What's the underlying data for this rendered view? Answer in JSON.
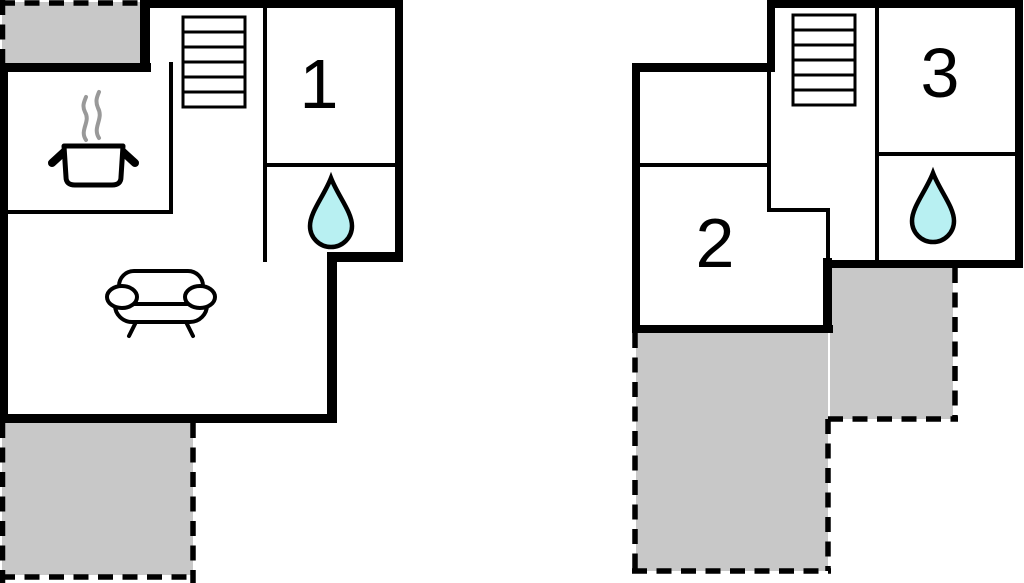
{
  "floorplan": {
    "rooms": {
      "room1_label": "1",
      "room2_label": "2",
      "room3_label": "3"
    },
    "colors": {
      "background": "#ffffff",
      "wall": "#000000",
      "terrace_fill": "#c8c8c8",
      "water_drop_fill": "#b8f0f2",
      "steam": "#999999"
    },
    "icons": {
      "stairs": "stairs-icon",
      "water_drop": "water-drop-icon",
      "cooking_pot": "cooking-pot-icon",
      "sofa": "sofa-icon"
    }
  }
}
